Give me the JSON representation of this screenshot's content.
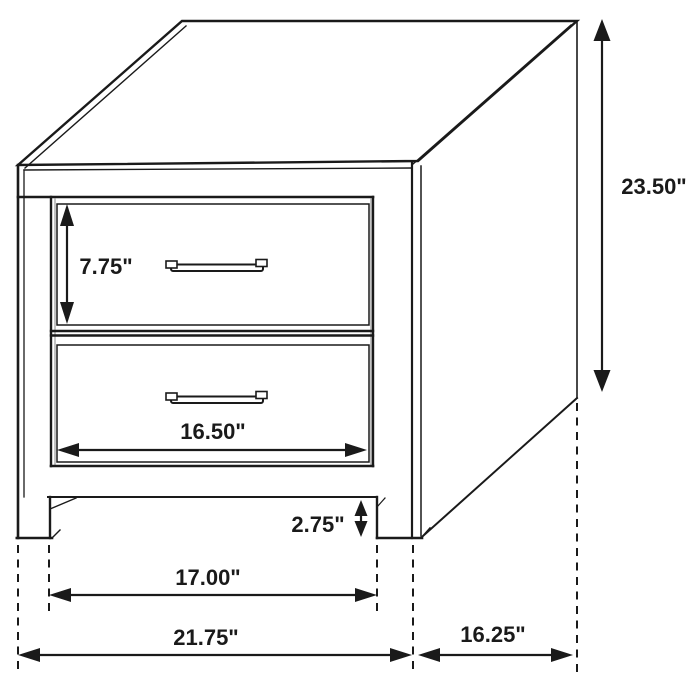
{
  "diagram": {
    "background_color": "#ffffff",
    "line_color": "#1a1a1a",
    "gap_line_color": "#9b9b9b",
    "labels": {
      "drawer_height": "7.75\"",
      "overall_height": "23.50\"",
      "drawer_width": "16.50\"",
      "clearance": "2.75\"",
      "leg_span": "17.00\"",
      "overall_width": "21.75\"",
      "depth": "16.25\""
    }
  }
}
